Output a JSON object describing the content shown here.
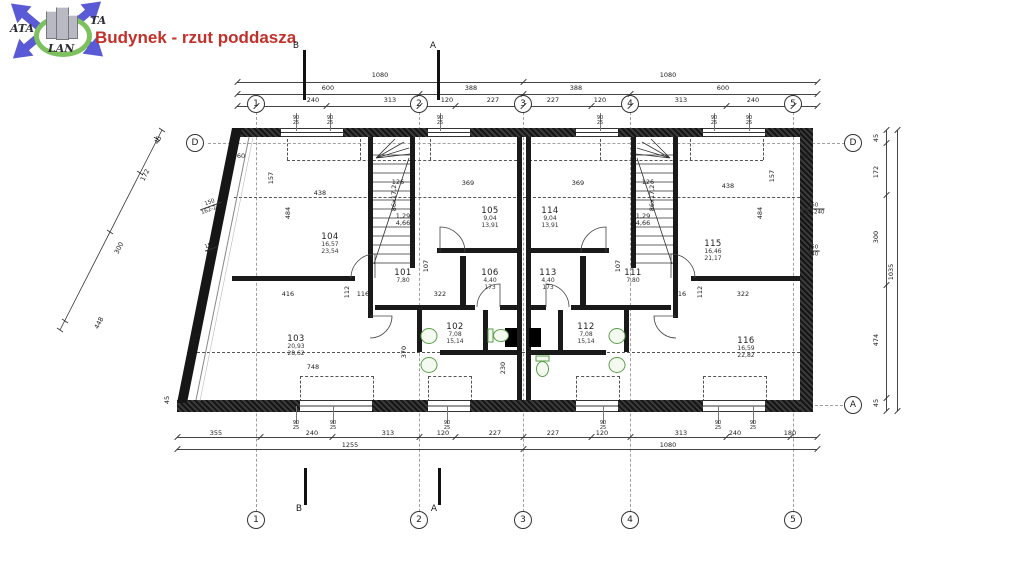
{
  "title": "Budynek - rzut poddasza",
  "logo": {
    "text_ata": "ATA",
    "text_ta": "TA",
    "text_lan": "LAN"
  },
  "colors": {
    "title": "#c2302a",
    "logo_blue": "#5a5ad6",
    "logo_green": "#7cc15e",
    "fixture_green": "#5a9e4a",
    "line": "#2b2b2b"
  },
  "grid": {
    "cols": [
      {
        "label": "1",
        "x": 256
      },
      {
        "label": "2",
        "x": 419
      },
      {
        "label": "3",
        "x": 523
      },
      {
        "label": "4",
        "x": 630
      },
      {
        "label": "5",
        "x": 793
      }
    ],
    "top_y": 104,
    "bottom_y": 520,
    "letters": [
      {
        "label": "D",
        "x": 195,
        "y": 143
      },
      {
        "label": "D",
        "x": 853,
        "y": 143
      },
      {
        "label": "A",
        "x": 853,
        "y": 405
      }
    ]
  },
  "sections": [
    {
      "label": "B",
      "x": 296,
      "y": 46
    },
    {
      "label": "A",
      "x": 433,
      "y": 46
    },
    {
      "label": "B",
      "x": 299,
      "y": 509
    },
    {
      "label": "A",
      "x": 434,
      "y": 509
    }
  ],
  "rooms": [
    {
      "id": "104",
      "areas": [
        "16,57",
        "23,54"
      ],
      "x": 330,
      "y": 232
    },
    {
      "id": "105",
      "areas": [
        "9,04",
        "13,91"
      ],
      "x": 490,
      "y": 206
    },
    {
      "id": "114",
      "areas": [
        "9,04",
        "13,91"
      ],
      "x": 550,
      "y": 206
    },
    {
      "id": "115",
      "areas": [
        "16,46",
        "21,17"
      ],
      "x": 713,
      "y": 239
    },
    {
      "id": "101",
      "areas": [
        "7,80"
      ],
      "x": 403,
      "y": 268
    },
    {
      "id": "111",
      "areas": [
        "7,80"
      ],
      "x": 633,
      "y": 268
    },
    {
      "id": "106",
      "areas": [
        "4,40",
        "173"
      ],
      "x": 490,
      "y": 268
    },
    {
      "id": "113",
      "areas": [
        "4,40",
        "173"
      ],
      "x": 548,
      "y": 268
    },
    {
      "id": "102",
      "areas": [
        "7,08",
        "15,14"
      ],
      "x": 455,
      "y": 322
    },
    {
      "id": "112",
      "areas": [
        "7,08",
        "15,14"
      ],
      "x": 586,
      "y": 322
    },
    {
      "id": "103",
      "areas": [
        "20,93",
        "28,62"
      ],
      "x": 296,
      "y": 334
    },
    {
      "id": "116",
      "areas": [
        "16,59",
        "22,82"
      ],
      "x": 746,
      "y": 336
    }
  ],
  "dims": [
    {
      "v": "1080",
      "x": 380,
      "y": 75
    },
    {
      "v": "1080",
      "x": 668,
      "y": 75
    },
    {
      "v": "600",
      "x": 328,
      "y": 88
    },
    {
      "v": "388",
      "x": 471,
      "y": 88
    },
    {
      "v": "388",
      "x": 576,
      "y": 88
    },
    {
      "v": "600",
      "x": 723,
      "y": 88
    },
    {
      "v": "240",
      "x": 313,
      "y": 100
    },
    {
      "v": "313",
      "x": 390,
      "y": 100
    },
    {
      "v": "120",
      "x": 447,
      "y": 100
    },
    {
      "v": "227",
      "x": 493,
      "y": 100
    },
    {
      "v": "227",
      "x": 553,
      "y": 100
    },
    {
      "v": "120",
      "x": 600,
      "y": 100
    },
    {
      "v": "313",
      "x": 681,
      "y": 100
    },
    {
      "v": "240",
      "x": 753,
      "y": 100
    },
    {
      "v": "355",
      "x": 216,
      "y": 433
    },
    {
      "v": "240",
      "x": 312,
      "y": 433
    },
    {
      "v": "313",
      "x": 388,
      "y": 433
    },
    {
      "v": "120",
      "x": 443,
      "y": 433
    },
    {
      "v": "227",
      "x": 495,
      "y": 433
    },
    {
      "v": "227",
      "x": 553,
      "y": 433
    },
    {
      "v": "120",
      "x": 602,
      "y": 433
    },
    {
      "v": "313",
      "x": 681,
      "y": 433
    },
    {
      "v": "240",
      "x": 735,
      "y": 433
    },
    {
      "v": "180",
      "x": 790,
      "y": 433
    },
    {
      "v": "1255",
      "x": 350,
      "y": 445
    },
    {
      "v": "1080",
      "x": 668,
      "y": 445
    },
    {
      "v": "45",
      "x": 876,
      "y": 138,
      "r": -90
    },
    {
      "v": "172",
      "x": 876,
      "y": 172,
      "r": -90
    },
    {
      "v": "300",
      "x": 876,
      "y": 237,
      "r": -90
    },
    {
      "v": "474",
      "x": 876,
      "y": 340,
      "r": -90
    },
    {
      "v": "45",
      "x": 876,
      "y": 403,
      "r": -90
    },
    {
      "v": "1035",
      "x": 891,
      "y": 272,
      "r": -90
    },
    {
      "v": "45",
      "x": 158,
      "y": 140,
      "r": -63
    },
    {
      "v": "172",
      "x": 145,
      "y": 175,
      "r": -63
    },
    {
      "v": "300",
      "x": 119,
      "y": 248,
      "r": -63
    },
    {
      "v": "448",
      "x": 99,
      "y": 323,
      "r": -63
    },
    {
      "v": "45",
      "x": 167,
      "y": 400,
      "r": -90
    },
    {
      "v": "60",
      "x": 241,
      "y": 156
    },
    {
      "v": "60",
      "x": 806,
      "y": 156
    },
    {
      "v": "157",
      "x": 271,
      "y": 178,
      "r": -90
    },
    {
      "v": "157",
      "x": 772,
      "y": 176,
      "r": -90
    },
    {
      "v": "438",
      "x": 320,
      "y": 193
    },
    {
      "v": "438",
      "x": 728,
      "y": 186
    },
    {
      "v": "369",
      "x": 468,
      "y": 183
    },
    {
      "v": "369",
      "x": 578,
      "y": 183
    },
    {
      "v": "484",
      "x": 288,
      "y": 213,
      "r": -90
    },
    {
      "v": "484",
      "x": 760,
      "y": 213,
      "r": -90
    },
    {
      "v": "126",
      "x": 398,
      "y": 182
    },
    {
      "v": "126",
      "x": 648,
      "y": 182
    },
    {
      "v": "107",
      "x": 426,
      "y": 266,
      "r": -90
    },
    {
      "v": "107",
      "x": 618,
      "y": 266,
      "r": -90
    },
    {
      "v": "1,29",
      "x": 403,
      "y": 216
    },
    {
      "v": "4,66",
      "x": 403,
      "y": 223
    },
    {
      "v": "1,29",
      "x": 643,
      "y": 216
    },
    {
      "v": "4,66",
      "x": 643,
      "y": 223
    },
    {
      "v": "416",
      "x": 288,
      "y": 294
    },
    {
      "v": "116",
      "x": 363,
      "y": 294
    },
    {
      "v": "322",
      "x": 440,
      "y": 294
    },
    {
      "v": "322",
      "x": 743,
      "y": 294
    },
    {
      "v": "116",
      "x": 680,
      "y": 294
    },
    {
      "v": "112",
      "x": 347,
      "y": 292,
      "r": -90
    },
    {
      "v": "112",
      "x": 700,
      "y": 292,
      "r": -90
    },
    {
      "v": "748",
      "x": 313,
      "y": 367
    },
    {
      "v": "370",
      "x": 404,
      "y": 352,
      "r": -90
    },
    {
      "v": "230",
      "x": 503,
      "y": 368,
      "r": -90
    },
    {
      "v": "449",
      "x": 194,
      "y": 340,
      "r": -75
    },
    {
      "v": "86x17,2",
      "x": 394,
      "y": 198,
      "r": -90
    },
    {
      "v": "86x17,2",
      "x": 652,
      "y": 198,
      "r": -90
    }
  ],
  "knee_labels": [
    {
      "t1": "150",
      "t2": "162-240",
      "x": 211,
      "y": 206,
      "r": -20
    },
    {
      "t1": "150",
      "t2": "240",
      "x": 211,
      "y": 249,
      "r": -20
    },
    {
      "t1": "150",
      "t2": "162-240",
      "x": 813,
      "y": 209,
      "r": 0
    },
    {
      "t1": "150",
      "t2": "240",
      "x": 813,
      "y": 251,
      "r": 0
    }
  ],
  "window_marks": {
    "top_value": "90",
    "bottom_value": "25",
    "top_xs": [
      296,
      330,
      440,
      600,
      714,
      749
    ],
    "bottom_xs": [
      296,
      333,
      447,
      603,
      718,
      753
    ]
  }
}
